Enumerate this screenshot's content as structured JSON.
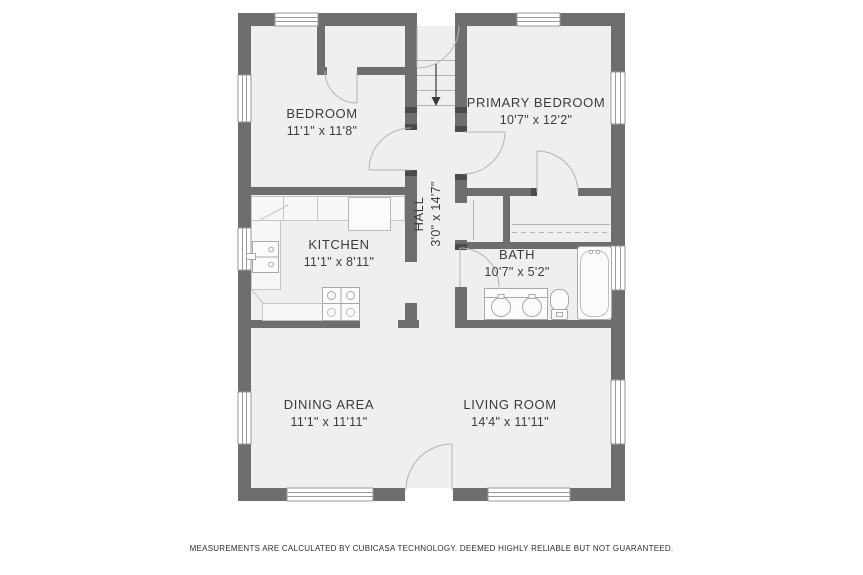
{
  "meta": {
    "type": "residential-floor-plan",
    "style": "CubiCasa 2D black-and-white plan"
  },
  "rooms": [
    {
      "id": "bedroom",
      "label": "BEDROOM",
      "dims": "11'1\" x 11'8\""
    },
    {
      "id": "primary-bedroom",
      "label": "PRIMARY BEDROOM",
      "dims": "10'7\" x 12'2\""
    },
    {
      "id": "hall",
      "label": "HALL",
      "dims": "3'0\" x 14'7\""
    },
    {
      "id": "kitchen",
      "label": "KITCHEN",
      "dims": "11'1\" x 8'11\""
    },
    {
      "id": "bath",
      "label": "BATH",
      "dims": "10'7\" x 5'2\""
    },
    {
      "id": "dining-area",
      "label": "DINING AREA",
      "dims": "11'1\" x 11'11\""
    },
    {
      "id": "living-room",
      "label": "LIVING ROOM",
      "dims": "14'4\" x 11'11\""
    }
  ],
  "fixtures": [
    "stairs-down-arrow",
    "kitchen-sink",
    "stove",
    "refrigerator",
    "kitchen-counter",
    "vanity-double-sink",
    "toilet",
    "bathtub",
    "closet-rod",
    "door-swing",
    "window"
  ],
  "colors": {
    "background": "#ffffff",
    "wall": "#6e6e6e",
    "floor": "#efefef",
    "fixture_line": "#b3b3b3",
    "counter_fill": "#f7f7f7",
    "text": "#3c3c3c"
  },
  "footer": {
    "disclaimer": "MEASUREMENTS ARE CALCULATED BY CUBICASA TECHNOLOGY. DEEMED HIGHLY RELIABLE BUT NOT GUARANTEED."
  }
}
